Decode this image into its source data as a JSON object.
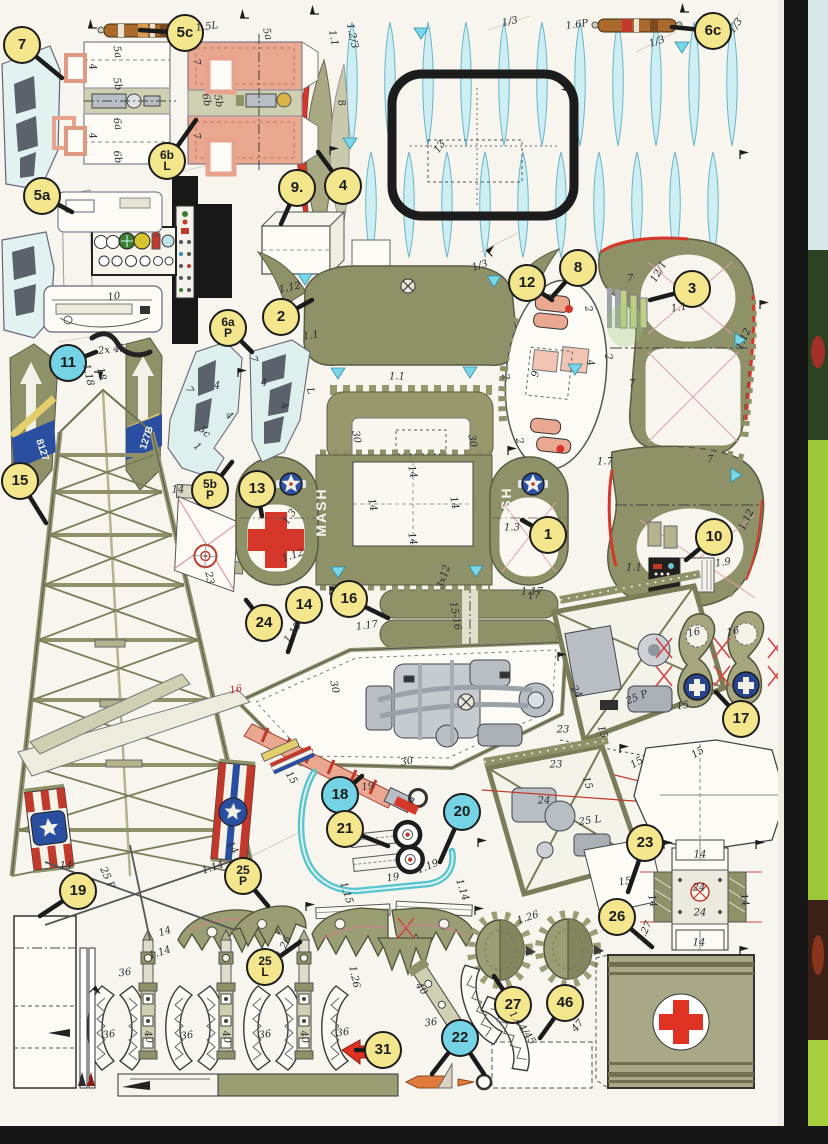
{
  "document_type": "paper model parts sheet (scan)",
  "colors": {
    "paper": "#f7f5ee",
    "olive_part": "#8f9168",
    "olive_band": "#cfd0b2",
    "salmon_part": "#eaa891",
    "red": "#d5382b",
    "canopy_cyan": "#cdeef3",
    "badge_yellow": "#f3e68c",
    "badge_cyan": "#74d4e6",
    "insignia_blue": "#2b4fa0",
    "stick_brown": "#a96a2c",
    "scan_edge_black": "#161616",
    "next_page_green": "#9cc736"
  },
  "badges": [
    {
      "label": "7",
      "x": 22,
      "y": 45,
      "color": "y",
      "lx": 62,
      "ly": 78
    },
    {
      "label": "5c",
      "x": 185,
      "y": 33,
      "color": "y",
      "lx": 140,
      "ly": 30
    },
    {
      "label": "6b|L",
      "x": 167,
      "y": 161,
      "color": "y",
      "lx": 196,
      "ly": 120
    },
    {
      "label": "5a",
      "x": 42,
      "y": 196,
      "color": "y",
      "lx": 72,
      "ly": 212
    },
    {
      "label": "9.",
      "x": 297,
      "y": 188,
      "color": "y",
      "lx": 281,
      "ly": 224
    },
    {
      "label": "4",
      "x": 343,
      "y": 186,
      "color": "y",
      "lx": 318,
      "ly": 152
    },
    {
      "label": "2",
      "x": 281,
      "y": 317,
      "color": "y",
      "lx": 312,
      "ly": 300
    },
    {
      "label": "6a|P",
      "x": 228,
      "y": 328,
      "color": "y",
      "lx": 252,
      "ly": 352
    },
    {
      "label": "12",
      "x": 527,
      "y": 283,
      "color": "y",
      "lx": 552,
      "ly": 300
    },
    {
      "label": "8",
      "x": 578,
      "y": 268,
      "color": "y",
      "lx": 553,
      "ly": 296
    },
    {
      "label": "3",
      "x": 692,
      "y": 289,
      "color": "y",
      "lx": 650,
      "ly": 300
    },
    {
      "label": "6c",
      "x": 713,
      "y": 31,
      "color": "y",
      "lx": 672,
      "ly": 27
    },
    {
      "label": "11",
      "x": 68,
      "y": 363,
      "color": "c",
      "lx": 96,
      "ly": 352
    },
    {
      "label": "15",
      "x": 20,
      "y": 481,
      "color": "y",
      "lx": 46,
      "ly": 523
    },
    {
      "label": "5b|P",
      "x": 210,
      "y": 490,
      "color": "y",
      "lx": 232,
      "ly": 462
    },
    {
      "label": "13",
      "x": 257,
      "y": 489,
      "color": "y",
      "lx": 262,
      "ly": 516
    },
    {
      "label": "1",
      "x": 548,
      "y": 535,
      "color": "y",
      "lx": 522,
      "ly": 520
    },
    {
      "label": "10",
      "x": 714,
      "y": 537,
      "color": "y",
      "lx": 686,
      "ly": 560
    },
    {
      "label": "24",
      "x": 264,
      "y": 623,
      "color": "y",
      "lx": 246,
      "ly": 600
    },
    {
      "label": "14",
      "x": 304,
      "y": 605,
      "color": "y",
      "lx": 288,
      "ly": 652
    },
    {
      "label": "16",
      "x": 349,
      "y": 599,
      "color": "y",
      "lx": 388,
      "ly": 618
    },
    {
      "label": "17",
      "x": 741,
      "y": 719,
      "color": "y",
      "lx": 716,
      "ly": 692
    },
    {
      "label": "18",
      "x": 340,
      "y": 795,
      "color": "c",
      "lx": 362,
      "ly": 776
    },
    {
      "label": "21",
      "x": 345,
      "y": 829,
      "color": "y",
      "lx": 388,
      "ly": 846
    },
    {
      "label": "20",
      "x": 462,
      "y": 812,
      "color": "c",
      "lx": 440,
      "ly": 862
    },
    {
      "label": "23",
      "x": 645,
      "y": 843,
      "color": "y",
      "lx": 628,
      "ly": 892
    },
    {
      "label": "26",
      "x": 617,
      "y": 917,
      "color": "y",
      "lx": 652,
      "ly": 947
    },
    {
      "label": "19",
      "x": 78,
      "y": 891,
      "color": "y",
      "lx": 40,
      "ly": 916
    },
    {
      "label": "25|P",
      "x": 243,
      "y": 876,
      "color": "y",
      "lx": 268,
      "ly": 906
    },
    {
      "label": "25|L",
      "x": 265,
      "y": 967,
      "color": "y",
      "lx": 300,
      "ly": 942
    },
    {
      "label": "27",
      "x": 513,
      "y": 1005,
      "color": "y",
      "lx": 494,
      "ly": 976
    },
    {
      "label": "46",
      "x": 565,
      "y": 1003,
      "color": "y",
      "lx": 540,
      "ly": 1038
    },
    {
      "label": "31",
      "x": 383,
      "y": 1050,
      "color": "y",
      "lx": 356,
      "ly": 1050
    },
    {
      "label": "22",
      "x": 460,
      "y": 1038,
      "color": "c",
      "lx": 432,
      "ly": 1074,
      "lx2": 484,
      "ly2": 1074
    }
  ],
  "annotations": [
    {
      "t": "1.5L",
      "x": 207,
      "y": 27,
      "r": -8
    },
    {
      "t": "5a",
      "x": 267,
      "y": 34,
      "r": 75
    },
    {
      "t": "1.2/3",
      "x": 352,
      "y": 36,
      "r": 78
    },
    {
      "t": "1.1",
      "x": 333,
      "y": 38,
      "r": 78
    },
    {
      "t": "1/3",
      "x": 510,
      "y": 22,
      "r": -12
    },
    {
      "t": "1.6P",
      "x": 577,
      "y": 25,
      "r": -8
    },
    {
      "t": "1/3",
      "x": 657,
      "y": 42,
      "r": -18
    },
    {
      "t": "1/3",
      "x": 736,
      "y": 26,
      "r": -55
    },
    {
      "t": "5a",
      "x": 117,
      "y": 52,
      "r": 80
    },
    {
      "t": "5b",
      "x": 117,
      "y": 84,
      "r": 80
    },
    {
      "t": "6a",
      "x": 117,
      "y": 124,
      "r": 80
    },
    {
      "t": "6b",
      "x": 117,
      "y": 157,
      "r": 80
    },
    {
      "t": "4",
      "x": 92,
      "y": 67,
      "r": 80
    },
    {
      "t": "4",
      "x": 92,
      "y": 136,
      "r": 80
    },
    {
      "t": "7",
      "x": 196,
      "y": 62,
      "r": 80
    },
    {
      "t": "7",
      "x": 196,
      "y": 136,
      "r": 80
    },
    {
      "t": "6b",
      "x": 206,
      "y": 100,
      "r": 80
    },
    {
      "t": "5b",
      "x": 218,
      "y": 101,
      "r": 80
    },
    {
      "t": "8",
      "x": 341,
      "y": 103,
      "r": 75
    },
    {
      "t": "13",
      "x": 440,
      "y": 147,
      "r": -55
    },
    {
      "t": "10",
      "x": 114,
      "y": 297,
      "r": -8
    },
    {
      "t": "1.12",
      "x": 290,
      "y": 288,
      "r": -12
    },
    {
      "t": "1/3",
      "x": 480,
      "y": 266,
      "r": -18
    },
    {
      "t": "1.1",
      "x": 311,
      "y": 336,
      "r": -8
    },
    {
      "t": "1.1",
      "x": 397,
      "y": 377,
      "r": 0
    },
    {
      "t": "2",
      "x": 505,
      "y": 377,
      "r": 78
    },
    {
      "t": "2",
      "x": 519,
      "y": 441,
      "r": 78
    },
    {
      "t": "30",
      "x": 356,
      "y": 437,
      "r": 80
    },
    {
      "t": "30",
      "x": 472,
      "y": 441,
      "r": 80
    },
    {
      "t": "12/1",
      "x": 659,
      "y": 272,
      "r": -60
    },
    {
      "t": "7",
      "x": 630,
      "y": 279,
      "r": 0
    },
    {
      "t": "1.1",
      "x": 679,
      "y": 308,
      "r": -8
    },
    {
      "t": "2",
      "x": 588,
      "y": 309,
      "r": 78
    },
    {
      "t": "9",
      "x": 536,
      "y": 374,
      "r": -78
    },
    {
      "t": "4",
      "x": 590,
      "y": 363,
      "r": 78
    },
    {
      "t": "2",
      "x": 608,
      "y": 357,
      "r": 78
    },
    {
      "t": "1.12",
      "x": 744,
      "y": 339,
      "r": -65
    },
    {
      "t": "7",
      "x": 632,
      "y": 384,
      "r": 0
    },
    {
      "t": "7",
      "x": 710,
      "y": 460,
      "r": 0
    },
    {
      "t": "1.7",
      "x": 605,
      "y": 462,
      "r": 0
    },
    {
      "t": "2x 45",
      "x": 112,
      "y": 350,
      "r": -6
    },
    {
      "t": "1.18",
      "x": 88,
      "y": 375,
      "r": 78
    },
    {
      "t": "18",
      "x": 101,
      "y": 374,
      "r": 78
    },
    {
      "t": "8127",
      "x": 42,
      "y": 450,
      "r": 72,
      "c": "#f4f4ee",
      "b": 1
    },
    {
      "t": "127B",
      "x": 147,
      "y": 438,
      "r": -72,
      "c": "#f4f4ee",
      "b": 1
    },
    {
      "t": "14",
      "x": 66,
      "y": 866,
      "r": 0
    },
    {
      "t": "14",
      "x": 232,
      "y": 848,
      "r": 60
    },
    {
      "t": "1.14",
      "x": 213,
      "y": 868,
      "r": -18
    },
    {
      "t": "7",
      "x": 189,
      "y": 390,
      "r": 60
    },
    {
      "t": "4",
      "x": 217,
      "y": 386,
      "r": 0
    },
    {
      "t": "5c",
      "x": 204,
      "y": 432,
      "r": 42
    },
    {
      "t": "1",
      "x": 197,
      "y": 447,
      "r": 42
    },
    {
      "t": "4",
      "x": 229,
      "y": 416,
      "r": 42
    },
    {
      "t": "7",
      "x": 253,
      "y": 359,
      "r": 75
    },
    {
      "t": "4",
      "x": 264,
      "y": 383,
      "r": 0
    },
    {
      "t": "L",
      "x": 310,
      "y": 391,
      "r": 75
    },
    {
      "t": "4",
      "x": 284,
      "y": 406,
      "r": 58
    },
    {
      "t": "MASH",
      "x": 321,
      "y": 512,
      "r": -90,
      "c": "#f6f6ef",
      "b": 1,
      "s": 14,
      "sp": 2
    },
    {
      "t": "MASH",
      "x": 506,
      "y": 511,
      "r": -90,
      "c": "#f6f6ef",
      "b": 1,
      "s": 14,
      "sp": 2
    },
    {
      "t": "14",
      "x": 412,
      "y": 472,
      "r": 78
    },
    {
      "t": "14",
      "x": 372,
      "y": 505,
      "r": 78
    },
    {
      "t": "14",
      "x": 454,
      "y": 503,
      "r": 78
    },
    {
      "t": "14",
      "x": 412,
      "y": 539,
      "r": 78
    },
    {
      "t": "1.3",
      "x": 290,
      "y": 517,
      "r": -55
    },
    {
      "t": "1.3",
      "x": 512,
      "y": 528,
      "r": 0
    },
    {
      "t": "1.12",
      "x": 293,
      "y": 556,
      "r": -18
    },
    {
      "t": "3x12",
      "x": 444,
      "y": 577,
      "r": -72
    },
    {
      "t": "1.17",
      "x": 532,
      "y": 592,
      "r": 0
    },
    {
      "t": "1.12",
      "x": 747,
      "y": 520,
      "r": -65
    },
    {
      "t": "1.9",
      "x": 723,
      "y": 563,
      "r": -8
    },
    {
      "t": "1.1",
      "x": 634,
      "y": 568,
      "r": 0
    },
    {
      "t": "23",
      "x": 209,
      "y": 578,
      "r": 78
    },
    {
      "t": "14",
      "x": 178,
      "y": 490,
      "r": 0
    },
    {
      "t": "1.15",
      "x": 293,
      "y": 633,
      "r": -55
    },
    {
      "t": "15-16",
      "x": 455,
      "y": 616,
      "r": 80
    },
    {
      "t": "1.17",
      "x": 367,
      "y": 626,
      "r": -8
    },
    {
      "t": "17",
      "x": 534,
      "y": 596,
      "r": -8
    },
    {
      "t": "30",
      "x": 334,
      "y": 687,
      "r": 78
    },
    {
      "t": "30",
      "x": 407,
      "y": 762,
      "r": -12
    },
    {
      "t": "16",
      "x": 236,
      "y": 690,
      "r": -12,
      "c": "#c03028"
    },
    {
      "t": "15",
      "x": 291,
      "y": 778,
      "r": 58
    },
    {
      "t": "16",
      "x": 694,
      "y": 633,
      "r": -12
    },
    {
      "t": "16",
      "x": 733,
      "y": 632,
      "r": -12
    },
    {
      "t": "25 P",
      "x": 637,
      "y": 698,
      "r": -22
    },
    {
      "t": "15",
      "x": 683,
      "y": 706,
      "r": -8
    },
    {
      "t": "15",
      "x": 602,
      "y": 732,
      "r": 72
    },
    {
      "t": "23",
      "x": 563,
      "y": 730,
      "r": 0
    },
    {
      "t": "24",
      "x": 576,
      "y": 692,
      "r": 58
    },
    {
      "t": "15",
      "x": 698,
      "y": 753,
      "r": -32
    },
    {
      "t": "15",
      "x": 637,
      "y": 763,
      "r": -32
    },
    {
      "t": "23",
      "x": 556,
      "y": 765,
      "r": 0
    },
    {
      "t": "24",
      "x": 544,
      "y": 801,
      "r": 0
    },
    {
      "t": "25 L",
      "x": 590,
      "y": 821,
      "r": -8
    },
    {
      "t": "15",
      "x": 587,
      "y": 783,
      "r": 72
    },
    {
      "t": "15",
      "x": 625,
      "y": 882,
      "r": -8
    },
    {
      "t": "19",
      "x": 368,
      "y": 787,
      "r": -8
    },
    {
      "t": "1.19",
      "x": 428,
      "y": 867,
      "r": -22
    },
    {
      "t": "19",
      "x": 393,
      "y": 878,
      "r": -8
    },
    {
      "t": "1.15",
      "x": 346,
      "y": 893,
      "r": 72
    },
    {
      "t": "1.14",
      "x": 462,
      "y": 890,
      "r": 72
    },
    {
      "t": "14",
      "x": 700,
      "y": 855,
      "r": 0
    },
    {
      "t": "24",
      "x": 699,
      "y": 888,
      "r": 0
    },
    {
      "t": "24",
      "x": 700,
      "y": 913,
      "r": 0
    },
    {
      "t": "14",
      "x": 699,
      "y": 943,
      "r": 0
    },
    {
      "t": "14",
      "x": 652,
      "y": 901,
      "r": 78
    },
    {
      "t": "14",
      "x": 744,
      "y": 900,
      "r": 78
    },
    {
      "t": "1.27",
      "x": 645,
      "y": 932,
      "r": -65
    },
    {
      "t": "1.26",
      "x": 284,
      "y": 947,
      "r": -65
    },
    {
      "t": "1.26",
      "x": 354,
      "y": 977,
      "r": 78
    },
    {
      "t": "1.26",
      "x": 528,
      "y": 918,
      "r": -18
    },
    {
      "t": "25 P",
      "x": 107,
      "y": 878,
      "r": 65
    },
    {
      "t": "14",
      "x": 165,
      "y": 932,
      "r": -18
    },
    {
      "t": "1.14",
      "x": 160,
      "y": 953,
      "r": -18
    },
    {
      "t": "36",
      "x": 125,
      "y": 973,
      "r": -8
    },
    {
      "t": "36",
      "x": 109,
      "y": 1035,
      "r": -8
    },
    {
      "t": "36",
      "x": 187,
      "y": 1036,
      "r": -8
    },
    {
      "t": "36",
      "x": 265,
      "y": 1035,
      "r": -8
    },
    {
      "t": "36",
      "x": 343,
      "y": 1033,
      "r": -8
    },
    {
      "t": "40",
      "x": 148,
      "y": 1037,
      "r": 80
    },
    {
      "t": "40",
      "x": 226,
      "y": 1037,
      "r": 80
    },
    {
      "t": "40",
      "x": 304,
      "y": 1037,
      "r": 80
    },
    {
      "t": "40",
      "x": 421,
      "y": 989,
      "r": 55
    },
    {
      "t": "36",
      "x": 431,
      "y": 1023,
      "r": -8
    },
    {
      "t": "1.44/45",
      "x": 522,
      "y": 1028,
      "r": 55
    },
    {
      "t": "47",
      "x": 578,
      "y": 1026,
      "r": -50
    }
  ]
}
